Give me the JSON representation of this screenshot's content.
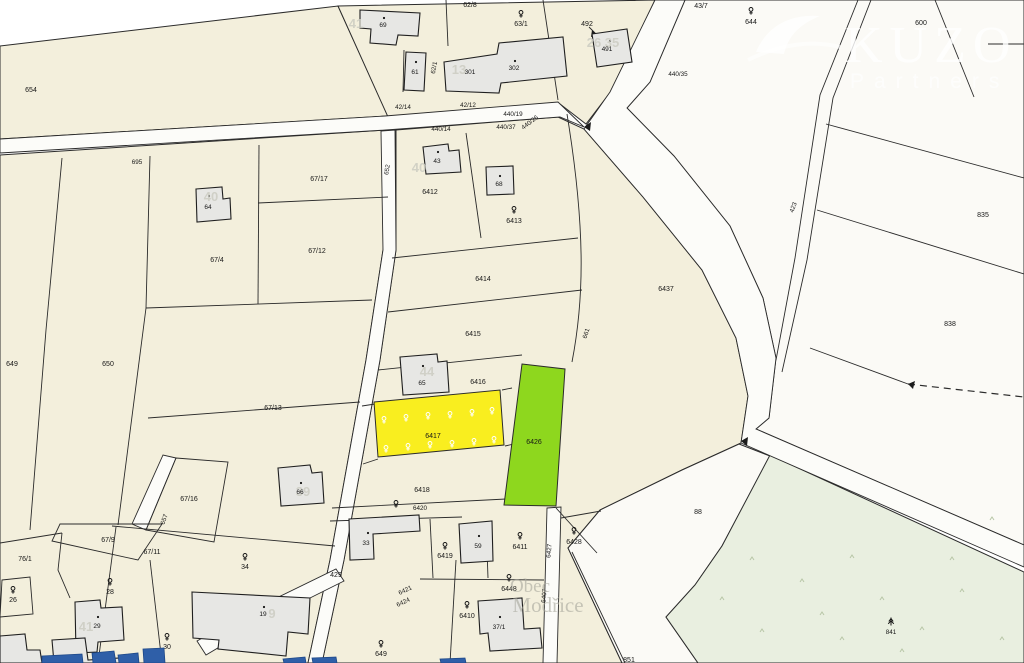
{
  "brand": {
    "name": "KUZO",
    "sub": "Partners"
  },
  "watermark": {
    "line1": "Obec",
    "line2": "Modřice"
  },
  "icons": {
    "tree": "tree-icon (fruit-tree cadastre symbol)",
    "conifer": "conifer-icon (coniferous tree symbol)"
  },
  "colors": {
    "parcel_cream": "#f3efdc",
    "parcel_white": "#fbfaf6",
    "highlight_yellow": "#f9ee1f",
    "highlight_green": "#8ed71e",
    "grass_green": "#e9efe0",
    "map_line": "#2b2b2b",
    "building_fill": "#e7e7e4",
    "water_blue": "#2f5fa8"
  },
  "labels": {
    "p654": "654",
    "p695": "695",
    "p67_17": "67/17",
    "p67_12": "67/12",
    "p67_4": "67/4",
    "p649a": "649",
    "p650": "650",
    "p67_13": "67/13",
    "p67_16": "67/16",
    "p657": "657",
    "p67_11": "67/11",
    "p67_9": "67/9",
    "p76_1": "76/1",
    "p26": "26",
    "p28": "28",
    "b29": "29",
    "p30": "30",
    "b19": "19",
    "b64": "64",
    "b66": "66",
    "p34": "34",
    "b69": "69",
    "b61": "61",
    "p62_1": "62/1",
    "p62_8": "62/8",
    "p63_1": "63/1",
    "b301": "301",
    "b302": "302",
    "p492": "492",
    "b491": "491",
    "p43_7": "43/7",
    "p644": "644",
    "p600": "600",
    "p440_35": "440/35",
    "p42_14": "42/14",
    "p42_12": "42/12",
    "p440_19": "440/19",
    "p440_14": "440/14",
    "p440_37": "440/37",
    "p440_26": "440/26",
    "p652": "652",
    "b43": "43",
    "p6412": "6412",
    "b68": "68",
    "p6413": "6413",
    "p6414": "6414",
    "p6415": "6415",
    "p661": "661",
    "p6416": "6416",
    "b65": "65",
    "p6417": "6417",
    "p6426": "6426",
    "p6437": "6437",
    "p423": "423",
    "p835": "835",
    "p838": "838",
    "p6418": "6418",
    "p6420": "6420",
    "p429": "429",
    "b33": "33",
    "p6419": "6419",
    "b59": "59",
    "p6411": "6411",
    "p6427": "6427",
    "p6428": "6428",
    "p6421": "6421",
    "p6424": "6424",
    "p6448": "6448",
    "p6407": "6407",
    "p6410": "6410",
    "b37_1": "37/1",
    "p649b": "649",
    "p851": "851",
    "p88": "88",
    "p841": "841"
  },
  "house_numbers": {
    "h41a": "41",
    "h13": "13",
    "h26_35": "26 35",
    "h40a": "40",
    "h40b": "40",
    "h44": "44",
    "h39": "39",
    "h41b": "41",
    "h9": "9"
  }
}
